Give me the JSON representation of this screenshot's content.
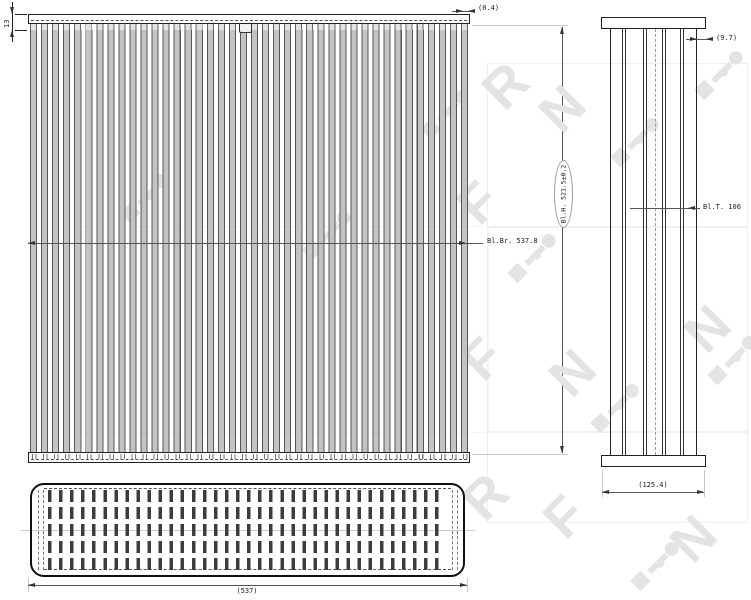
{
  "front_view": {
    "dim_tank_height": "13",
    "dim_fin_thickness": "(0.4)",
    "dim_block_width": "Bl.Br. 537.8",
    "dim_block_height": "Bl.H. 521.5±0.2"
  },
  "side_view": {
    "dim_tube_inset": "(9.7)",
    "dim_block_depth": "Bl.T. 106",
    "dim_overall_depth": "(125.4)"
  },
  "bottom_view": {
    "dim_overall_width": "(537)"
  },
  "watermark": {
    "brand": "NRF",
    "marks": [
      "R",
      "F",
      "N",
      "F",
      "N",
      "R",
      "N",
      "F",
      "N"
    ]
  }
}
